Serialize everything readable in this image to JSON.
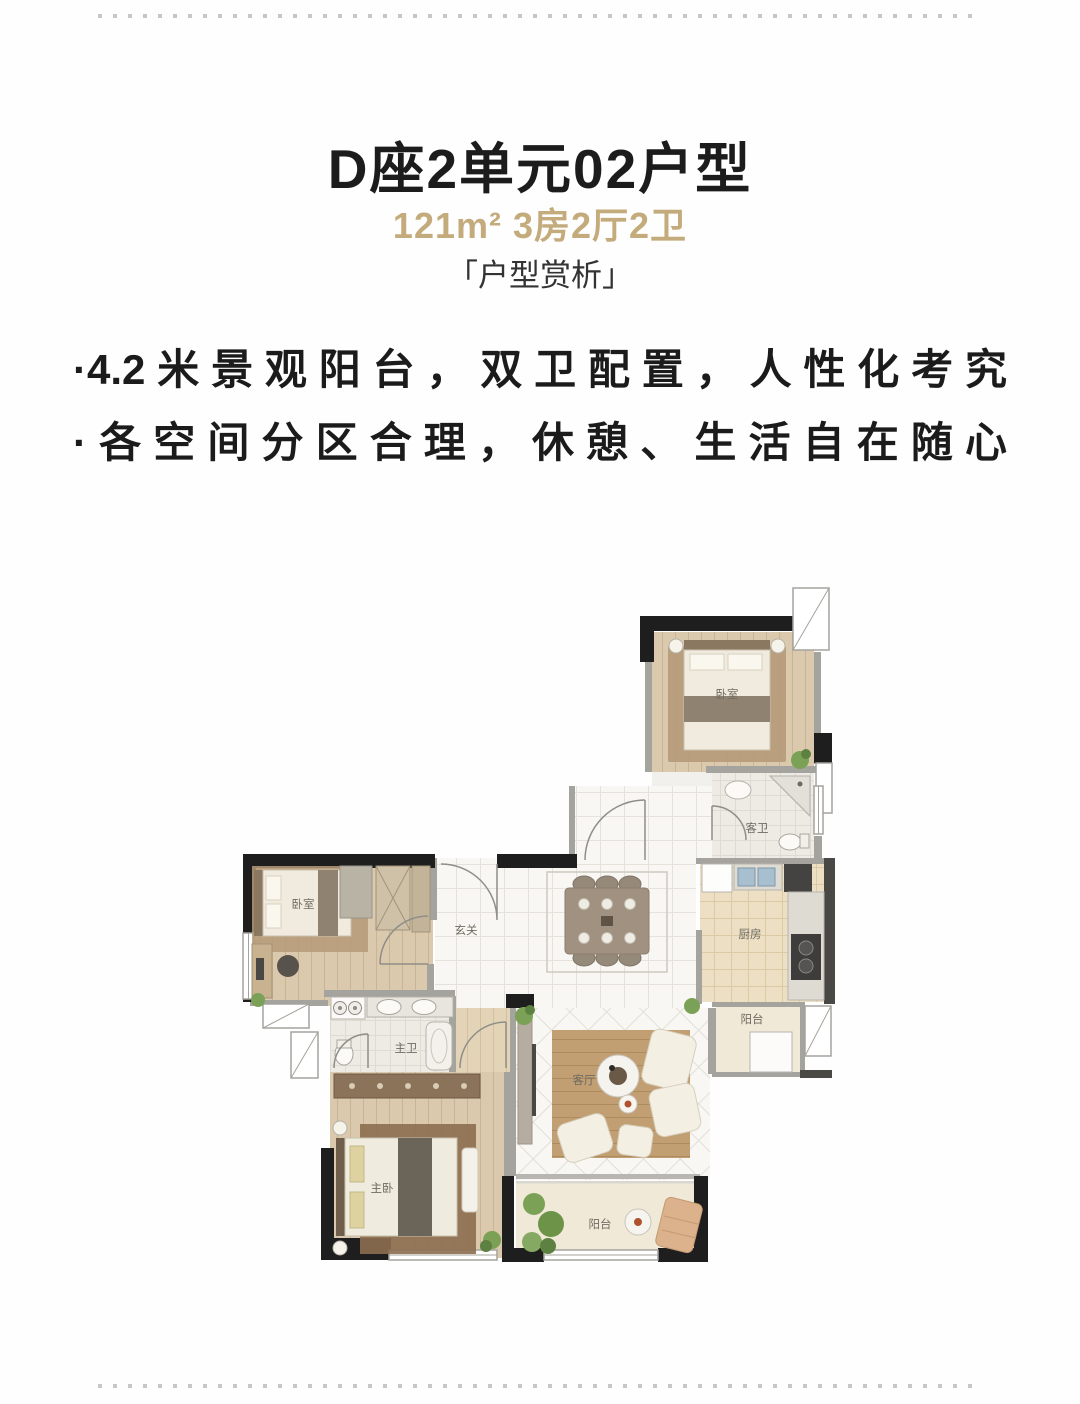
{
  "header": {
    "title": "D座2单元02户型",
    "subtitle": "121m² 3房2厅2卫",
    "section_label": "「户型赏析」"
  },
  "highlights": [
    "·4.2米景观阳台，双卫配置，人性化考究",
    "·各空间分区合理，休憩、生活自在随心"
  ],
  "colors": {
    "accent_gold": "#c3ab7c",
    "text_dark": "#1b1b1b",
    "wall_black": "#1e1e1e"
  },
  "floorplan": {
    "labels": {
      "bedroom_top_right": "卧室",
      "guest_bathroom": "客卫",
      "kitchen": "厨房",
      "balcony_right": "阳台",
      "entry": "玄关",
      "bedroom_left": "卧室",
      "master_bathroom": "主卫",
      "master_bedroom": "主卧",
      "living_room": "客厅",
      "balcony_bottom": "阳台"
    }
  }
}
